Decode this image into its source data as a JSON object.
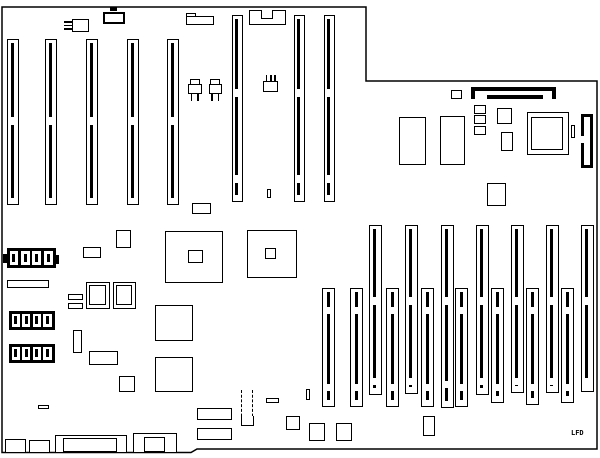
{
  "diagram": {
    "kind": "motherboard-layout-line-drawing",
    "bg_color": "#ffffff",
    "line_color": "#000000",
    "width": 600,
    "height": 458,
    "outline_points": "2,7 366,7 366,81 597,81 597,449 197,449 191,452.5 2,452.5"
  },
  "labels": {
    "lfd": "LFD"
  },
  "shapes": [
    {
      "name": "connector-3pin-left",
      "type": "pins3left",
      "x": 63.5,
      "y": 19,
      "w": 25.5,
      "h": 13,
      "pinLen": 8,
      "bodyW": 17.5
    },
    {
      "name": "power-tab-connector",
      "type": "tabrect",
      "x": 103,
      "y": 11.5,
      "w": 21.5,
      "h": 12,
      "tabW": 7,
      "tabH": 4
    },
    {
      "name": "stepped-connector",
      "type": "notchrect",
      "x": 186,
      "y": 16,
      "w": 27.5,
      "h": 9,
      "tabW": 10,
      "tabH": 4.5
    },
    {
      "name": "keyed-connector",
      "type": "keyed",
      "x": 249,
      "y": 10,
      "w": 37,
      "h": 15,
      "notchX": 11,
      "notchW": 12,
      "notchH": 9
    },
    {
      "name": "transistor",
      "type": "transistor",
      "x": 187.5,
      "y": 78.5,
      "w": 14,
      "capW": 10,
      "capH": 5,
      "bodyH": 10,
      "legH": 7
    },
    {
      "name": "transistor",
      "type": "transistor",
      "x": 208.5,
      "y": 78.5,
      "w": 13.5,
      "capW": 10,
      "capH": 5,
      "bodyH": 10,
      "legH": 7
    },
    {
      "name": "component-3pin-top",
      "type": "pins3top",
      "x": 263,
      "y": 75,
      "w": 15,
      "h": 17,
      "pinLen": 6,
      "bodyH": 11
    },
    {
      "name": "expansion-slot",
      "type": "slot",
      "x": 7,
      "y": 39,
      "w": 11.5,
      "h": 166,
      "gaps": [
        [
          117,
          125
        ]
      ]
    },
    {
      "name": "expansion-slot",
      "type": "slot",
      "x": 45,
      "y": 39,
      "w": 11.5,
      "h": 166,
      "gaps": [
        [
          117,
          125
        ]
      ]
    },
    {
      "name": "expansion-slot",
      "type": "slot",
      "x": 86,
      "y": 39,
      "w": 11.5,
      "h": 166,
      "gaps": [
        [
          117,
          125
        ]
      ]
    },
    {
      "name": "expansion-slot",
      "type": "slot",
      "x": 127,
      "y": 39,
      "w": 11.5,
      "h": 166,
      "gaps": [
        [
          117,
          125
        ]
      ]
    },
    {
      "name": "expansion-slot",
      "type": "slot",
      "x": 167,
      "y": 39,
      "w": 11.5,
      "h": 166,
      "gaps": [
        [
          117,
          125
        ]
      ]
    },
    {
      "name": "expansion-slot-long",
      "type": "slot",
      "x": 232,
      "y": 15,
      "w": 10.5,
      "h": 187,
      "gaps": [
        [
          89,
          97
        ],
        [
          175,
          183
        ]
      ]
    },
    {
      "name": "expansion-slot-long",
      "type": "slot",
      "x": 294,
      "y": 15,
      "w": 10.5,
      "h": 187,
      "gaps": [
        [
          89,
          97
        ],
        [
          175,
          183
        ]
      ]
    },
    {
      "name": "expansion-slot-long",
      "type": "slot",
      "x": 324,
      "y": 15,
      "w": 10.5,
      "h": 187,
      "gaps": [
        [
          89,
          97
        ],
        [
          175,
          183
        ]
      ]
    },
    {
      "name": "memory-slot-tall",
      "type": "slot",
      "x": 369,
      "y": 225,
      "w": 12.5,
      "h": 170,
      "gaps": [
        [
          297,
          305
        ],
        [
          378,
          385
        ]
      ]
    },
    {
      "name": "memory-slot-tall",
      "type": "slot",
      "x": 405,
      "y": 225,
      "w": 12.5,
      "h": 169,
      "gaps": [
        [
          297,
          305
        ],
        [
          378,
          385
        ]
      ]
    },
    {
      "name": "memory-slot-tall",
      "type": "slot",
      "x": 441,
      "y": 225,
      "w": 12.5,
      "h": 183,
      "gaps": [
        [
          297,
          305
        ],
        [
          381,
          388
        ]
      ]
    },
    {
      "name": "memory-slot-tall",
      "type": "slot",
      "x": 476,
      "y": 225,
      "w": 12.5,
      "h": 170,
      "gaps": [
        [
          297,
          305
        ],
        [
          378,
          385
        ]
      ]
    },
    {
      "name": "memory-slot-tall",
      "type": "slot",
      "x": 511,
      "y": 225,
      "w": 12.5,
      "h": 168,
      "gaps": [
        [
          297,
          305
        ],
        [
          378,
          385
        ]
      ]
    },
    {
      "name": "memory-slot-tall",
      "type": "slot",
      "x": 546,
      "y": 225,
      "w": 12.5,
      "h": 168,
      "gaps": [
        [
          297,
          305
        ],
        [
          378,
          385
        ]
      ]
    },
    {
      "name": "memory-slot-tall",
      "type": "slot",
      "x": 581,
      "y": 225,
      "w": 12.5,
      "h": 167,
      "gaps": [
        [
          297,
          305
        ],
        [
          378,
          385
        ]
      ]
    },
    {
      "name": "memory-slot-short",
      "type": "slot",
      "x": 322,
      "y": 288,
      "w": 13,
      "h": 119,
      "gaps": [
        [
          307,
          314
        ],
        [
          384,
          391
        ]
      ]
    },
    {
      "name": "memory-slot-short",
      "type": "slot",
      "x": 350,
      "y": 288,
      "w": 13,
      "h": 119,
      "gaps": [
        [
          307,
          314
        ],
        [
          384,
          391
        ]
      ]
    },
    {
      "name": "memory-slot-short",
      "type": "slot",
      "x": 386,
      "y": 288,
      "w": 13,
      "h": 119,
      "gaps": [
        [
          307,
          314
        ],
        [
          384,
          391
        ]
      ]
    },
    {
      "name": "memory-slot-short",
      "type": "slot",
      "x": 421,
      "y": 288,
      "w": 13,
      "h": 119,
      "gaps": [
        [
          307,
          314
        ],
        [
          384,
          391
        ]
      ]
    },
    {
      "name": "memory-slot-short",
      "type": "slot",
      "x": 455,
      "y": 288,
      "w": 13,
      "h": 119,
      "gaps": [
        [
          307,
          314
        ],
        [
          384,
          391
        ]
      ]
    },
    {
      "name": "memory-slot-short",
      "type": "slot",
      "x": 491,
      "y": 288,
      "w": 13,
      "h": 115,
      "gaps": [
        [
          307,
          314
        ],
        [
          384,
          391
        ]
      ]
    },
    {
      "name": "memory-slot-short",
      "type": "slot",
      "x": 526,
      "y": 288,
      "w": 13,
      "h": 117,
      "gaps": [
        [
          307,
          314
        ],
        [
          384,
          391
        ]
      ]
    },
    {
      "name": "memory-slot-short",
      "type": "slot",
      "x": 561,
      "y": 288,
      "w": 13,
      "h": 115,
      "gaps": [
        [
          307,
          314
        ],
        [
          384,
          391
        ]
      ]
    },
    {
      "name": "pin-mark",
      "type": "rect",
      "x": 267,
      "y": 189,
      "w": 3.5,
      "h": 9
    },
    {
      "name": "small-ic",
      "type": "rect",
      "x": 192,
      "y": 203,
      "w": 19,
      "h": 10.5
    },
    {
      "name": "battery",
      "type": "cellbox",
      "x": 6.5,
      "y": 248,
      "w": 49,
      "h": 20,
      "cells": 4
    },
    {
      "name": "battery-terminal",
      "type": "solid",
      "x": 3,
      "y": 254,
      "w": 4,
      "h": 9
    },
    {
      "name": "battery-terminal",
      "type": "solid",
      "x": 55.5,
      "y": 255,
      "w": 3.5,
      "h": 9
    },
    {
      "name": "connector-bar",
      "type": "rect",
      "x": 7,
      "y": 279.5,
      "w": 41.5,
      "h": 8
    },
    {
      "name": "jumper-bar",
      "type": "rect",
      "x": 67.5,
      "y": 293.5,
      "w": 15.5,
      "h": 6
    },
    {
      "name": "jumper-bar",
      "type": "rect",
      "x": 67.5,
      "y": 303,
      "w": 15.5,
      "h": 5.5
    },
    {
      "name": "socketed-chip",
      "type": "rect2",
      "x": 86,
      "y": 282,
      "w": 24,
      "h": 26.5,
      "inner": [
        3.5,
        3.5,
        17,
        19.5
      ]
    },
    {
      "name": "socketed-chip",
      "type": "rect2",
      "x": 112.5,
      "y": 282,
      "w": 23.5,
      "h": 26.5,
      "inner": [
        3.5,
        3.5,
        16.5,
        19.5
      ]
    },
    {
      "name": "small-ic",
      "type": "rect",
      "x": 83,
      "y": 247,
      "w": 18,
      "h": 11
    },
    {
      "name": "small-ic",
      "type": "rect",
      "x": 116,
      "y": 230,
      "w": 15,
      "h": 18
    },
    {
      "name": "large-chip",
      "type": "rect2",
      "x": 165,
      "y": 231,
      "w": 58,
      "h": 52,
      "inner": [
        23,
        19,
        15,
        13
      ]
    },
    {
      "name": "large-chip",
      "type": "rect2",
      "x": 247,
      "y": 230,
      "w": 50,
      "h": 48,
      "inner": [
        18.5,
        18,
        11,
        11.5
      ]
    },
    {
      "name": "small-ic",
      "type": "rect",
      "x": 73,
      "y": 330,
      "w": 9,
      "h": 23
    },
    {
      "name": "small-ic",
      "type": "rect",
      "x": 89,
      "y": 351,
      "w": 28.5,
      "h": 13.5
    },
    {
      "name": "small-ic",
      "type": "rect",
      "x": 119,
      "y": 376,
      "w": 15.5,
      "h": 16
    },
    {
      "name": "rom-chip",
      "type": "rect",
      "x": 155,
      "y": 305,
      "w": 38,
      "h": 36
    },
    {
      "name": "rom-chip",
      "type": "rect",
      "x": 155,
      "y": 356.5,
      "w": 37.5,
      "h": 35.5
    },
    {
      "name": "dip-switch",
      "type": "cellbox",
      "x": 8.5,
      "y": 310.5,
      "w": 46,
      "h": 19,
      "cells": 4
    },
    {
      "name": "dip-switch",
      "type": "cellbox",
      "x": 8.5,
      "y": 344,
      "w": 46,
      "h": 18.5,
      "cells": 4
    },
    {
      "name": "jumper-bar",
      "type": "rect",
      "x": 38,
      "y": 405,
      "w": 11,
      "h": 4
    },
    {
      "name": "edge-connector",
      "type": "rect",
      "x": 4.5,
      "y": 439,
      "w": 21,
      "h": 13.5
    },
    {
      "name": "edge-connector",
      "type": "rect",
      "x": 28.5,
      "y": 440,
      "w": 21,
      "h": 12.5
    },
    {
      "name": "keyboard-connector",
      "type": "rect2",
      "x": 54.5,
      "y": 435,
      "w": 72,
      "h": 17.5,
      "inner": [
        9,
        3.5,
        53.5,
        14
      ]
    },
    {
      "name": "power-connector",
      "type": "rect2",
      "x": 133,
      "y": 432.5,
      "w": 43.5,
      "h": 20,
      "inner": [
        11,
        5,
        21.5,
        15
      ]
    },
    {
      "name": "small-ic",
      "type": "rect",
      "x": 197,
      "y": 407.5,
      "w": 35,
      "h": 12.5
    },
    {
      "name": "small-ic",
      "type": "rect",
      "x": 197,
      "y": 427.5,
      "w": 35,
      "h": 12
    },
    {
      "name": "jumper-block-dashed",
      "type": "dashed",
      "x": 241,
      "y": 390,
      "w": 12,
      "h": 36
    },
    {
      "name": "jumper-bar",
      "type": "rect",
      "x": 266,
      "y": 397.5,
      "w": 13,
      "h": 5
    },
    {
      "name": "pin-mark",
      "type": "rect",
      "x": 305.5,
      "y": 388.5,
      "w": 4,
      "h": 11.5
    },
    {
      "name": "small-ic",
      "type": "rect",
      "x": 285.5,
      "y": 415.5,
      "w": 14,
      "h": 14
    },
    {
      "name": "small-ic",
      "type": "rect",
      "x": 309,
      "y": 422.5,
      "w": 16,
      "h": 18.5
    },
    {
      "name": "small-ic",
      "type": "rect",
      "x": 336,
      "y": 422.5,
      "w": 16,
      "h": 18.5
    },
    {
      "name": "small-ic",
      "type": "rect",
      "x": 422.5,
      "y": 416,
      "w": 12.5,
      "h": 19.5
    },
    {
      "name": "small-ic",
      "type": "rect",
      "x": 451,
      "y": 89.5,
      "w": 11,
      "h": 9
    },
    {
      "name": "header-connector-bar",
      "type": "solid",
      "x": 470.5,
      "y": 87,
      "w": 85.5,
      "h": 4
    },
    {
      "name": "header-connector-leg",
      "type": "solid",
      "x": 470.5,
      "y": 91,
      "w": 4,
      "h": 8
    },
    {
      "name": "header-connector-leg",
      "type": "solid",
      "x": 552,
      "y": 91,
      "w": 4,
      "h": 8
    },
    {
      "name": "header-connector-bar",
      "type": "solid",
      "x": 487,
      "y": 95,
      "w": 56,
      "h": 4
    },
    {
      "name": "small-ic",
      "type": "rect",
      "x": 473.5,
      "y": 104.5,
      "w": 12,
      "h": 9
    },
    {
      "name": "small-ic",
      "type": "rect",
      "x": 473.5,
      "y": 115,
      "w": 12,
      "h": 9
    },
    {
      "name": "small-ic",
      "type": "rect",
      "x": 473.5,
      "y": 125.5,
      "w": 12,
      "h": 9
    },
    {
      "name": "small-ic",
      "type": "rect",
      "x": 497,
      "y": 108,
      "w": 15,
      "h": 15.5
    },
    {
      "name": "small-ic",
      "type": "rect",
      "x": 501,
      "y": 132,
      "w": 11.5,
      "h": 19
    },
    {
      "name": "cpu-socket",
      "type": "rect2",
      "x": 526.5,
      "y": 112,
      "w": 42,
      "h": 43,
      "inner": [
        5,
        5,
        32,
        33
      ]
    },
    {
      "name": "pin-mark",
      "type": "rect",
      "x": 570.5,
      "y": 125,
      "w": 4.5,
      "h": 13
    },
    {
      "name": "din-connector",
      "type": "thickgap",
      "x": 580.5,
      "y": 114,
      "w": 12.5,
      "h": 54,
      "gapTop": 19,
      "gapH": 7
    },
    {
      "name": "ram-chip",
      "type": "rect",
      "x": 399,
      "y": 116.5,
      "w": 26.5,
      "h": 48
    },
    {
      "name": "ram-chip",
      "type": "rect",
      "x": 440,
      "y": 115.5,
      "w": 25,
      "h": 49.5
    },
    {
      "name": "small-ic",
      "type": "rect",
      "x": 486.5,
      "y": 182.5,
      "w": 19.5,
      "h": 23.5
    },
    {
      "name": "label-lfd",
      "type": "text",
      "x": 571,
      "y": 429,
      "w": 18,
      "h": 9,
      "bind": "labels.lfd"
    }
  ]
}
